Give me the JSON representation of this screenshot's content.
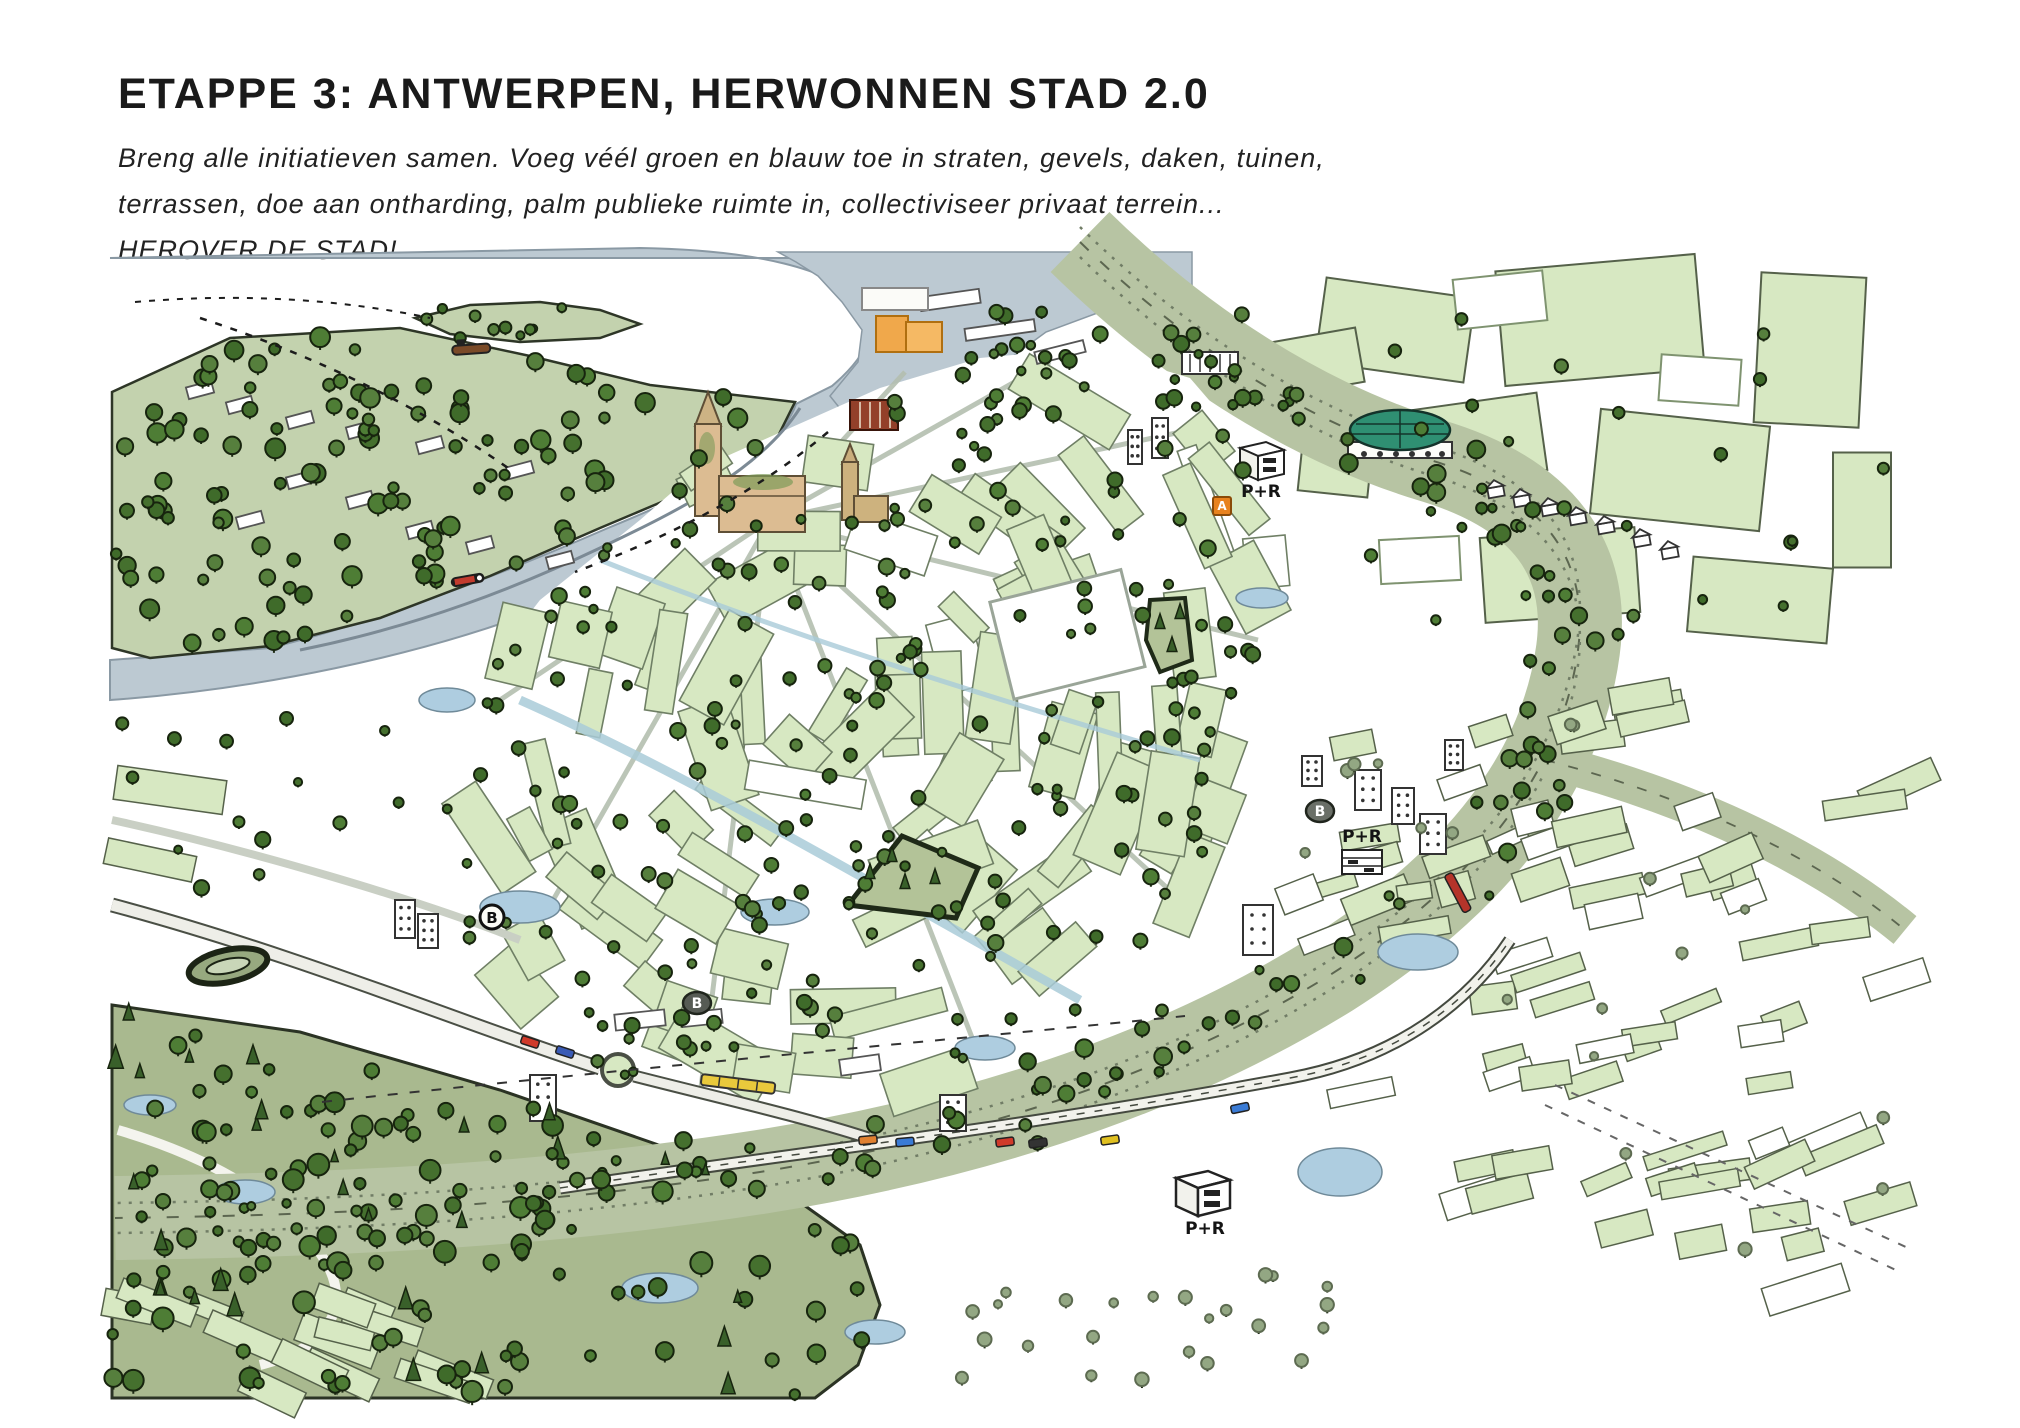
{
  "page": {
    "title": "ETAPPE 3: ANTWERPEN, HERWONNEN STAD 2.0",
    "intro_line1": "Breng alle initiatieven samen. Voeg véél groen en blauw toe in straten, gevels, daken, tuinen,",
    "intro_line2": "terrassen, doe aan ontharding, palm publieke ruimte in, collectiviseer privaat terrein...",
    "intro_line3": "HEROVER DE STAD!"
  },
  "map": {
    "markers": {
      "park_ride_top": "P+R",
      "park_ride_right": "P+R",
      "park_ride_bottom": "P+R",
      "transit_stop_b1": "B",
      "transit_stop_b2": "B",
      "transit_stop_b3": "B",
      "transit_stop_a": "A"
    },
    "colors": {
      "water": "#bcc9d2",
      "block_green": "#d7e8c2",
      "bank_green": "#c3d2ae",
      "ring_green": "#b7c4a3",
      "forest_green": "#a9b98f",
      "tree_green": "#4e7d35",
      "pond_blue": "#aecde0",
      "landmark_orange": "#f0a84b",
      "cathedral_tan": "#dcbc92",
      "dome_teal": "#2f8f72"
    }
  }
}
